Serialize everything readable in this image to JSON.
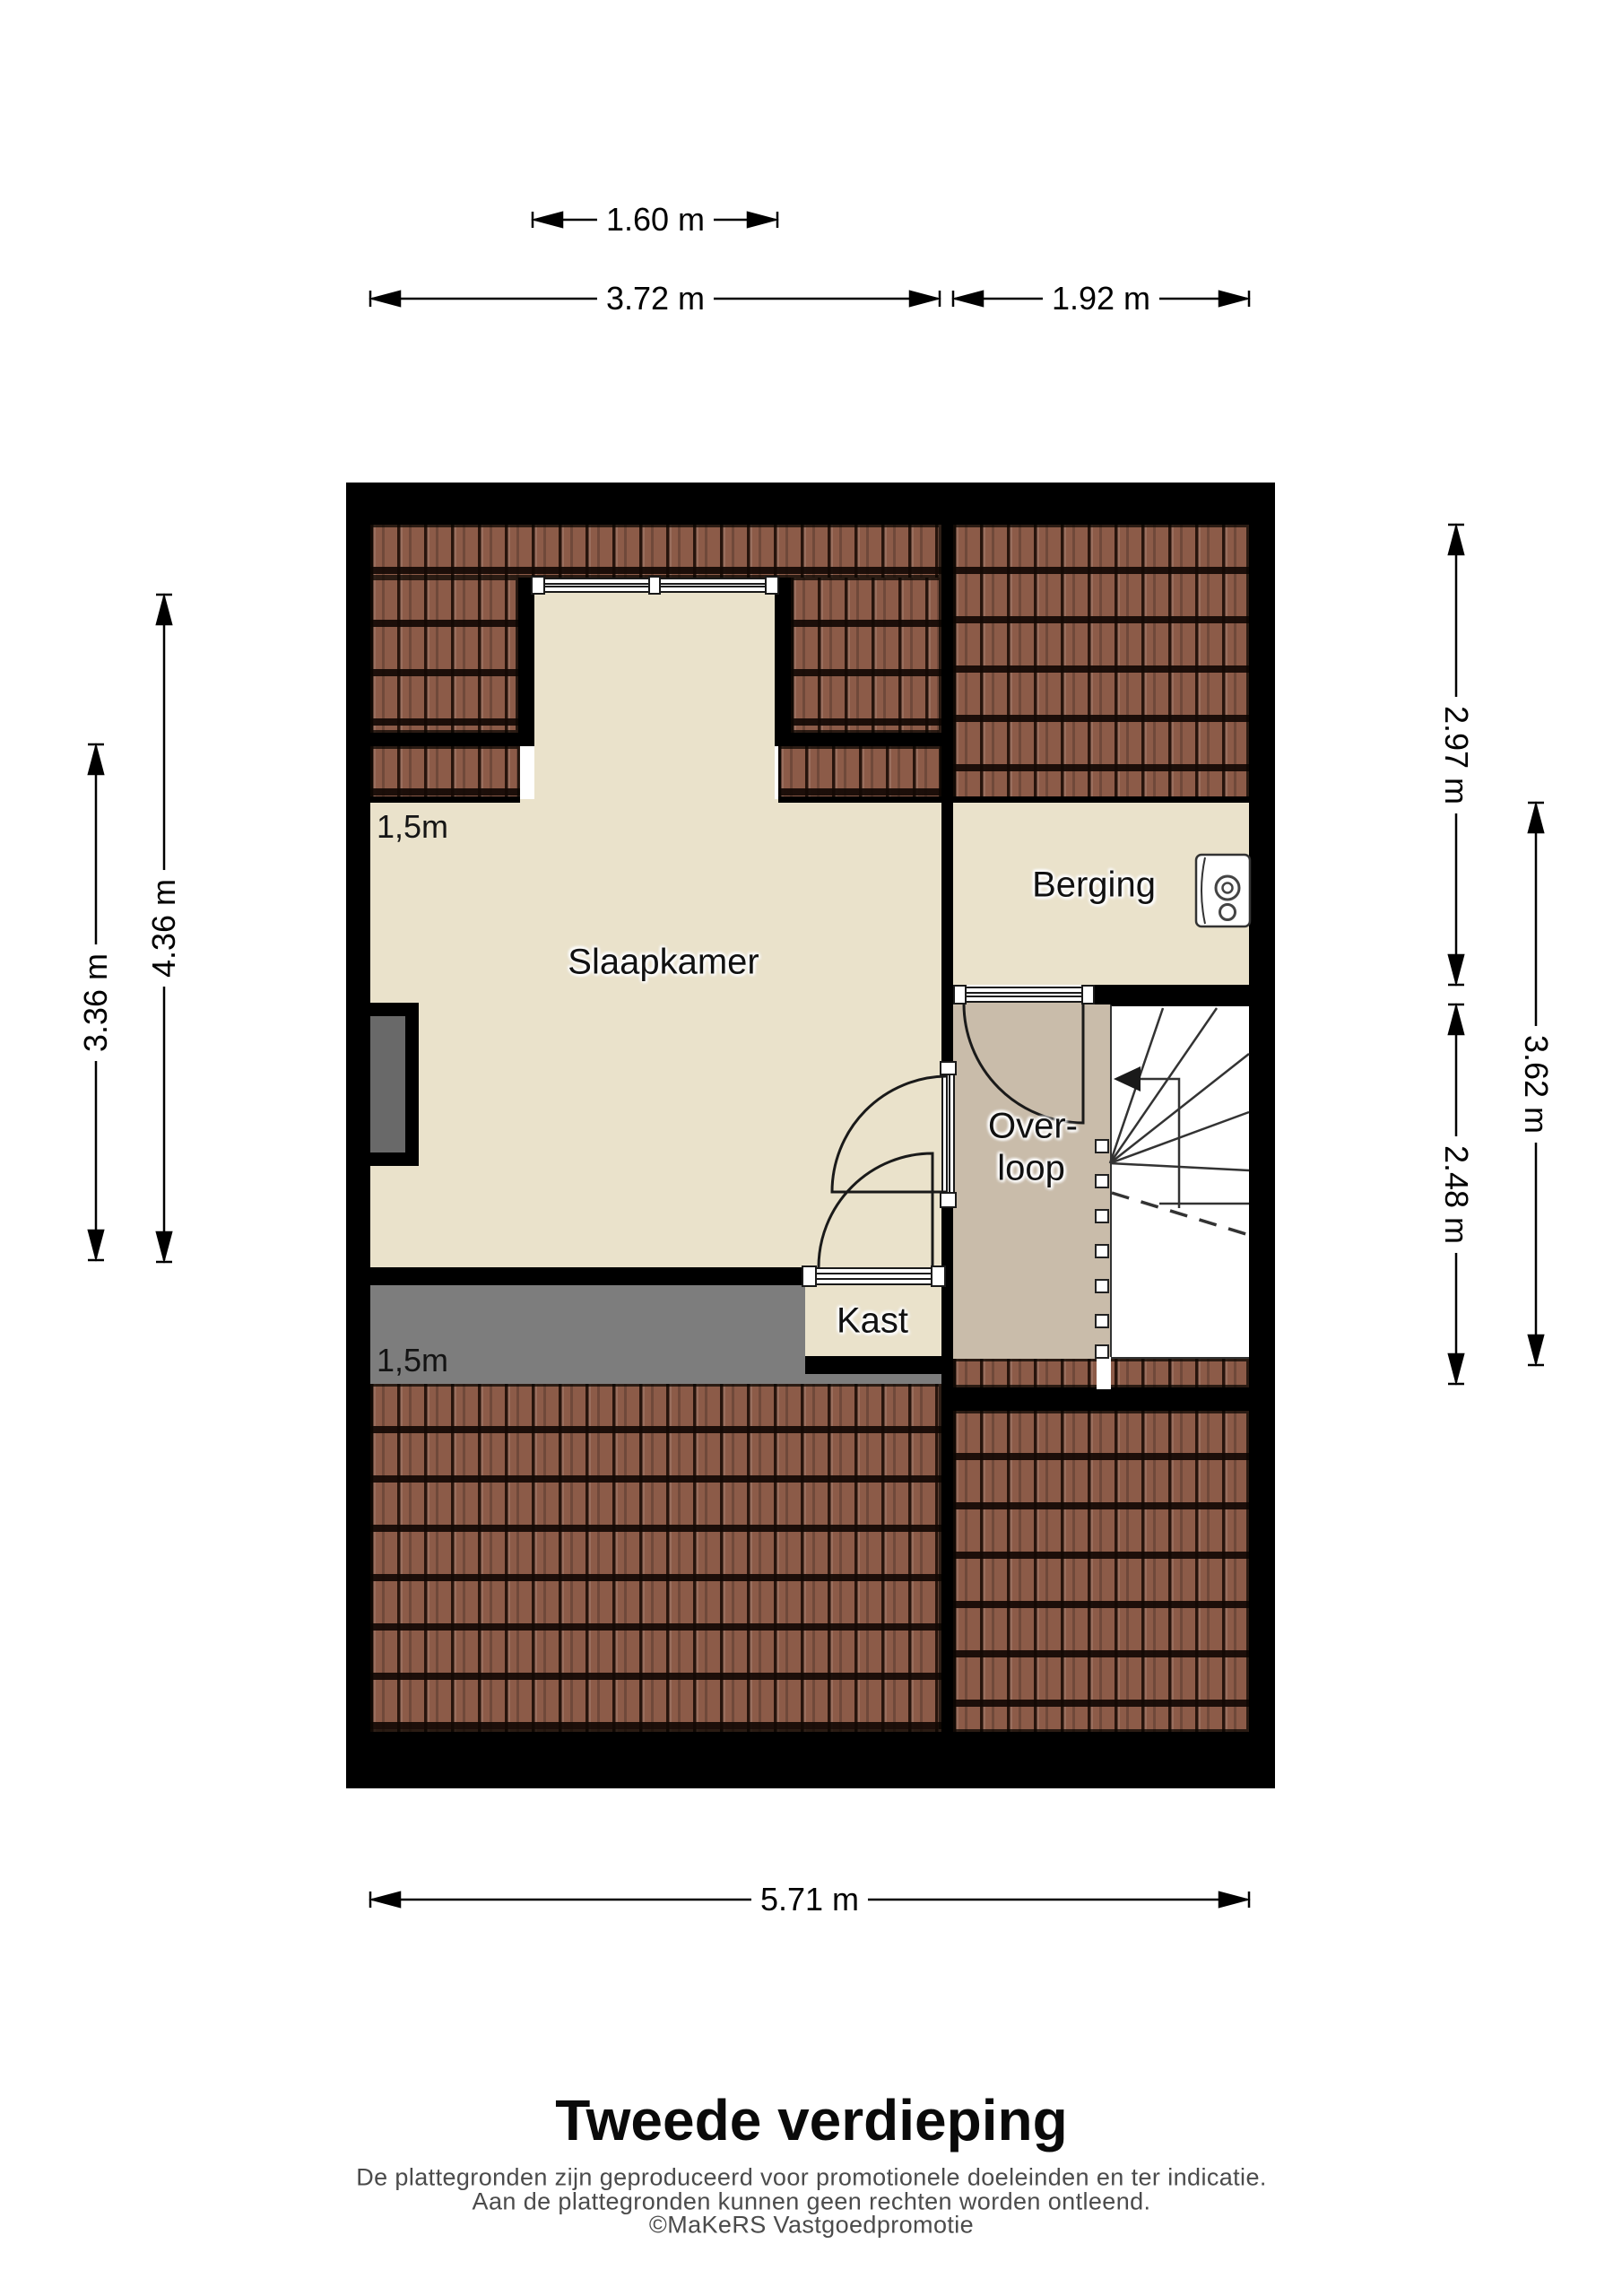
{
  "title": "Tweede verdieping",
  "footer": {
    "line1": "De plattegronden zijn geproduceerd voor promotionele doeleinden en ter indicatie.",
    "line2": "Aan de plattegronden kunnen geen rechten worden ontleend.",
    "line3": "©MaKeRS Vastgoedpromotie"
  },
  "rooms": {
    "slaapkamer": "Slaapkamer",
    "berging": "Berging",
    "overloop_line1": "Over-",
    "overloop_line2": "loop",
    "kast": "Kast"
  },
  "wall_height_labels": {
    "top": "1,5m",
    "bottom": "1,5m"
  },
  "dimensions": {
    "window": "1.60 m",
    "top_left": "3.72 m",
    "top_right": "1.92 m",
    "bottom": "5.71 m",
    "left_outer": "3.36 m",
    "left_inner": "4.36 m",
    "right_top": "2.97 m",
    "right_bottom": "2.48 m",
    "right_full": "3.62 m"
  },
  "colors": {
    "wall": "#000000",
    "floor": "#EAE2CB",
    "landing_floor": "#C9BCAA",
    "roof_tile": "#8C5B48",
    "knee_wall": "#7D7D7D",
    "stairwell": "#FFFFFF"
  }
}
